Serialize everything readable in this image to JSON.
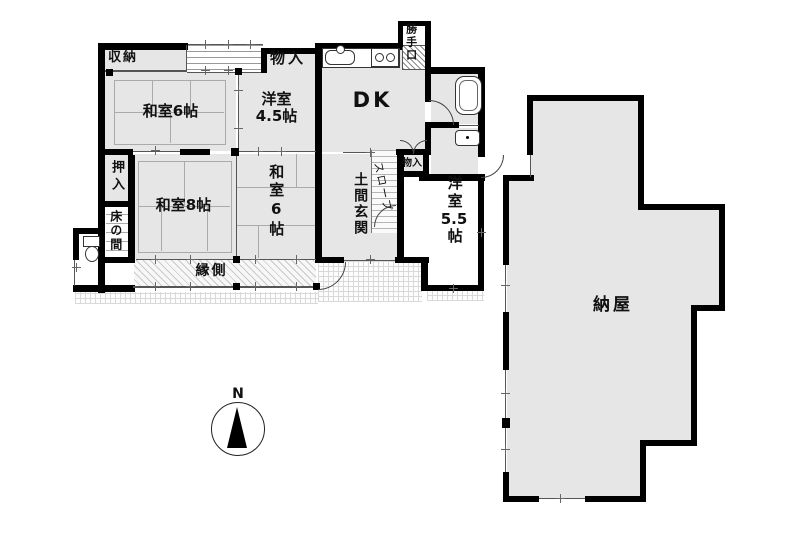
{
  "floor_plan": {
    "rooms": {
      "shunou": {
        "label": "収納"
      },
      "monoire_top": {
        "label": "物入"
      },
      "katteguchi": {
        "label": "勝手口"
      },
      "washitsu6_top": {
        "label": "和室6帖"
      },
      "youshitsu45": {
        "line1": "洋室",
        "line2": "4.5帖"
      },
      "dk": {
        "label": "DK"
      },
      "oshiire": {
        "label": "押入"
      },
      "washitsu8": {
        "label": "和室8帖"
      },
      "washitsu6_mid": {
        "label": "和室6帖"
      },
      "doma_genkan": {
        "label": "土間玄関"
      },
      "slope": {
        "label": "スロープ"
      },
      "monoire_mid": {
        "label": "物入"
      },
      "tokonoma": {
        "label": "床の間"
      },
      "engawa": {
        "label": "縁側"
      },
      "youshitsu55": {
        "line1": "洋室",
        "line2": "5.5",
        "line3": "帖"
      },
      "naya": {
        "label": "納屋"
      }
    },
    "compass": {
      "label": "N"
    },
    "colors": {
      "wall": "#000000",
      "room_fill": "#e6e6e6",
      "thin_line": "#555555",
      "background": "#ffffff"
    }
  }
}
